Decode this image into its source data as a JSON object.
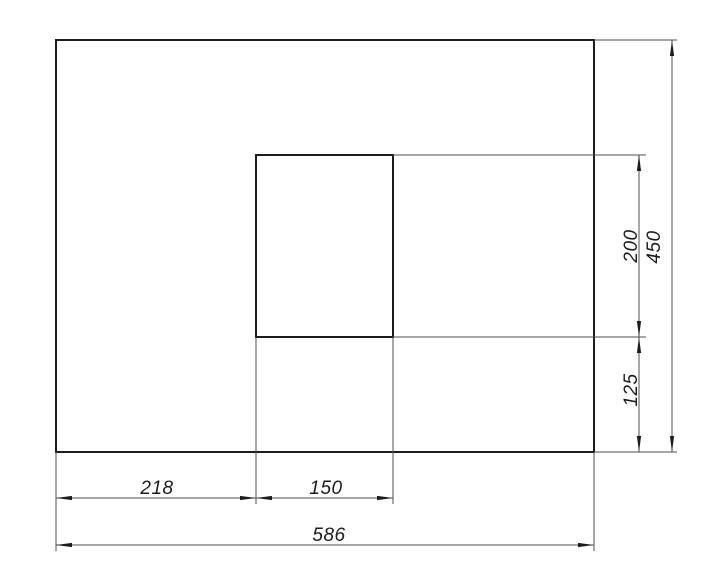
{
  "drawing": {
    "type": "dimensioned-technical-drawing",
    "description": "Outer rectangle with inset inner rectangle and CAD-style linear dimensions",
    "colors": {
      "background": "#ffffff",
      "outline": "#1c1c1c",
      "thin_line": "#4f4f4f"
    },
    "dimensions": {
      "width_left_segment": "218",
      "width_inner": "150",
      "width_total": "586",
      "height_inner": "200",
      "height_lower_segment": "125",
      "height_total": "450"
    }
  }
}
